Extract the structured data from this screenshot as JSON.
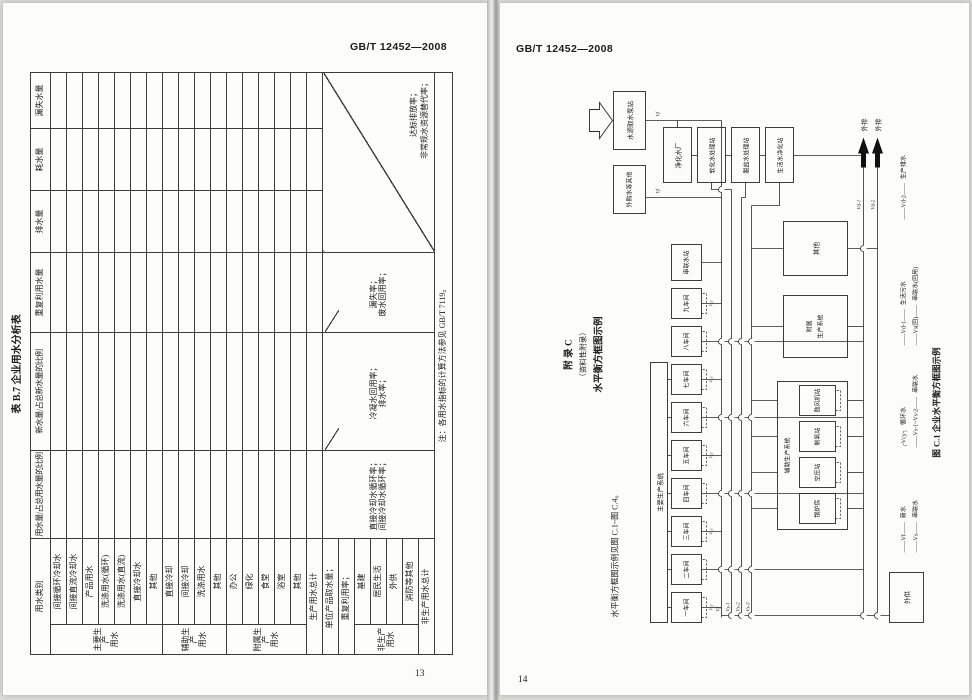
{
  "left_page": {
    "doc_number": "GB/T 12452—2008",
    "page_number": "13",
    "table": {
      "title": "表 B.7  企业用水分析表",
      "col_category": "用水类别",
      "col_headers": [
        "用水量/占总用水量的比例",
        "新水量/占总新水量的比例",
        "重复利用水量",
        "排水量",
        "耗水量",
        "漏失水量"
      ],
      "groups": [
        {
          "label1": "主要生产",
          "label2": "用水",
          "items": [
            "间接循环冷却水",
            "间接直流冷却水",
            "产品用水",
            "洗涤用水(循环)",
            "洗涤用水(直流)",
            "直接冷却水",
            "其他"
          ]
        },
        {
          "label1": "辅助生产",
          "label2": "用水",
          "items": [
            "直接冷却",
            "间接冷却",
            "洗涤用水",
            "其他"
          ]
        },
        {
          "label1": "附属生产",
          "label2": "用水",
          "items": [
            "办公",
            "绿化",
            "食堂",
            "浴室",
            "其他"
          ]
        }
      ],
      "production_total": "生产用水总计",
      "summary_rows": [
        "单位产品取水量；",
        "重复利用率；"
      ],
      "indicators": {
        "col3a": "直接冷却水循环率；",
        "col3b": "间接冷却水循环率；",
        "col4a": "冷凝水回用率；",
        "col4b": "排水率；",
        "col5a": "漏失率；",
        "col5b": "废水回用率；",
        "col678a": "达标排放率；",
        "col678b": "非常规水资源替代率；"
      },
      "nonprod_group": {
        "label1": "非生产",
        "label2": "用水",
        "items": [
          "基建",
          "居民生活",
          "外供",
          "消防等其他"
        ]
      },
      "nonprod_total": "非生产用水总计",
      "note": "注：各用水指标的计算方法参见 GB/T 7119。"
    }
  },
  "right_page": {
    "doc_number": "GB/T 12452—2008",
    "page_number": "14",
    "appendix_title": "附  录  C",
    "appendix_subtitle": "（资料性附录）",
    "appendix_heading": "水平衡方框图示例",
    "body_text": "水平衡方框图示例见图 C.1~图 C.4。",
    "figure": {
      "caption": "图 C.1  企业水平衡方框图示例",
      "boxes": {
        "intake": "水源取水泵站",
        "purchased": "外购水等其他",
        "purify": "净化水厂",
        "soften": "软化水处理站",
        "desalt": "脱盐水处理站",
        "domestic": "生活水净化站",
        "main_system": "主要生产系统",
        "workshops": [
          "一车间",
          "二车间",
          "三车间",
          "四车间",
          "五车间",
          "六车间",
          "七车间",
          "八车间",
          "九车间"
        ],
        "cascade_station": "串联水站",
        "aux_system": "辅助生产系统",
        "aux_stations": [
          "锅炉房",
          "空压站",
          "制氧站",
          "鼓风机站"
        ],
        "attached_l1": "附属",
        "attached_l2": "生产系统",
        "other": "其他",
        "external_supply": "外供",
        "discharge1": "外排",
        "discharge2": "外排"
      },
      "flow_labels": {
        "vf": "Vf",
        "vs1": "Vs-1",
        "vs2": "Vs-2",
        "vs3": "Vs-3",
        "vcy": "Vcy",
        "vd1": "Vd-1",
        "vd2": "Vd-2"
      },
      "legend": [
        {
          "sym": "——Vf——",
          "label": "新水"
        },
        {
          "sym": "┌Vcy┐",
          "label": "循环水"
        },
        {
          "sym": "——Vd-1——",
          "label": "生活污水"
        },
        {
          "sym": "——Vd-2——",
          "label": "生产排水"
        },
        {
          "sym": "——Vs——",
          "label": "串联水"
        },
        {
          "sym": "——Vs-1~Vs-2——",
          "label": "串联水"
        },
        {
          "sym": "——Vs(回)——",
          "label": "串联水(回用)"
        }
      ]
    }
  }
}
